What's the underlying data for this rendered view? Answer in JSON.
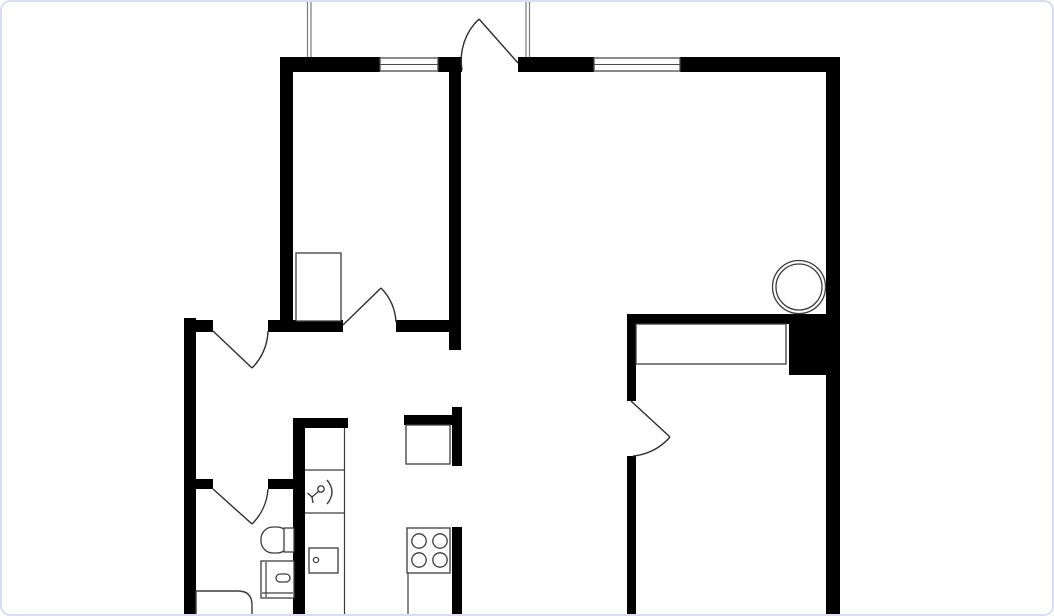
{
  "canvas": {
    "width": 1054,
    "height": 616,
    "background": "#ffffff",
    "card_border_color": "#d8ddf1",
    "card_radius": 10,
    "wall_color": "#000000",
    "line_color": "#3d3d3d",
    "door_color": "#2e2e2e",
    "guide_color": "#7a7a7a"
  },
  "floorplan": {
    "elements": [
      {
        "name": "top-wall-segment-1",
        "kind": "wall",
        "x": 280,
        "y": 57,
        "w": 100,
        "h": 15
      },
      {
        "name": "top-wall-segment-2",
        "kind": "wall",
        "x": 438,
        "y": 57,
        "w": 24,
        "h": 15
      },
      {
        "name": "top-wall-segment-3",
        "kind": "wall",
        "x": 518,
        "y": 57,
        "w": 76,
        "h": 15
      },
      {
        "name": "top-wall-segment-4",
        "kind": "wall",
        "x": 680,
        "y": 57,
        "w": 146,
        "h": 15
      },
      {
        "name": "right-exterior-wall",
        "kind": "wall",
        "x": 826,
        "y": 57,
        "w": 14,
        "h": 559
      },
      {
        "name": "bedroom1-west-wall",
        "kind": "wall",
        "x": 280,
        "y": 57,
        "w": 13,
        "h": 264
      },
      {
        "name": "bedroom1-east-wall",
        "kind": "wall",
        "x": 449,
        "y": 72,
        "w": 12,
        "h": 278
      },
      {
        "name": "hall-north-wall-segment-1",
        "kind": "wall",
        "x": 184,
        "y": 320,
        "w": 29,
        "h": 12
      },
      {
        "name": "hall-north-wall-segment-2",
        "kind": "wall",
        "x": 268,
        "y": 320,
        "w": 75,
        "h": 12
      },
      {
        "name": "hall-north-wall-segment-3",
        "kind": "wall",
        "x": 396,
        "y": 320,
        "w": 65,
        "h": 12
      },
      {
        "name": "left-exterior-wall",
        "kind": "wall",
        "x": 184,
        "y": 318,
        "w": 12,
        "h": 298
      },
      {
        "name": "bathroom-north-wall-segment-1",
        "kind": "wall",
        "x": 196,
        "y": 479,
        "w": 17,
        "h": 10
      },
      {
        "name": "bathroom-north-wall-segment-2",
        "kind": "wall",
        "x": 268,
        "y": 479,
        "w": 37,
        "h": 10
      },
      {
        "name": "kitchen-west-wall",
        "kind": "wall",
        "x": 293,
        "y": 418,
        "w": 12,
        "h": 198
      },
      {
        "name": "kitchen-west-wall-cap",
        "kind": "wall",
        "x": 293,
        "y": 418,
        "w": 55,
        "h": 10
      },
      {
        "name": "shaft-north-wall",
        "kind": "wall",
        "x": 404,
        "y": 415,
        "w": 48,
        "h": 10
      },
      {
        "name": "shaft-east-wall",
        "kind": "wall",
        "x": 452,
        "y": 407,
        "w": 10,
        "h": 59
      },
      {
        "name": "kitchen-east-wall",
        "kind": "wall",
        "x": 452,
        "y": 527,
        "w": 10,
        "h": 89
      },
      {
        "name": "bedroom2-north-wall",
        "kind": "wall",
        "x": 627,
        "y": 314,
        "w": 162,
        "h": 10
      },
      {
        "name": "duct-block",
        "kind": "wall",
        "x": 789,
        "y": 314,
        "w": 37,
        "h": 61
      },
      {
        "name": "bedroom2-west-wall-upper",
        "kind": "wall",
        "x": 627,
        "y": 314,
        "w": 9,
        "h": 87
      },
      {
        "name": "bedroom2-west-wall-lower",
        "kind": "wall",
        "x": 627,
        "y": 456,
        "w": 9,
        "h": 160
      },
      {
        "name": "window-1",
        "kind": "window",
        "x": 380,
        "y": 58,
        "w": 58,
        "h": 13
      },
      {
        "name": "window-2",
        "kind": "window",
        "x": 594,
        "y": 58,
        "w": 86,
        "h": 13
      },
      {
        "name": "exterior-guide-line-1",
        "kind": "line",
        "x1": 307.5,
        "y1": 0,
        "x2": 307.5,
        "y2": 57,
        "stroke": "#7a7a7a"
      },
      {
        "name": "exterior-guide-line-2",
        "kind": "line",
        "x1": 311,
        "y1": 0,
        "x2": 311,
        "y2": 57,
        "stroke": "#7a7a7a"
      },
      {
        "name": "exterior-guide-line-3",
        "kind": "line",
        "x1": 526,
        "y1": 0,
        "x2": 526,
        "y2": 57,
        "stroke": "#7a7a7a"
      },
      {
        "name": "exterior-guide-line-4",
        "kind": "line",
        "x1": 529.5,
        "y1": 0,
        "x2": 529.5,
        "y2": 57,
        "stroke": "#7a7a7a"
      },
      {
        "name": "bedroom1-closet",
        "kind": "rect",
        "x": 296,
        "y": 253,
        "w": 45,
        "h": 68
      },
      {
        "name": "bedroom2-closet",
        "kind": "rect",
        "x": 636,
        "y": 324,
        "w": 150,
        "h": 40
      },
      {
        "name": "shaft-box",
        "kind": "rect",
        "x": 406,
        "y": 425,
        "w": 44,
        "h": 39
      },
      {
        "name": "counter-left-front-edge",
        "kind": "line",
        "x1": 344.5,
        "y1": 428,
        "x2": 344.5,
        "y2": 614
      },
      {
        "name": "counter-left-divider-1",
        "kind": "line",
        "x1": 305,
        "y1": 470,
        "x2": 344,
        "y2": 470
      },
      {
        "name": "counter-left-divider-2",
        "kind": "line",
        "x1": 305,
        "y1": 513,
        "x2": 344,
        "y2": 513
      },
      {
        "name": "counter-right-front-edge",
        "kind": "line",
        "x1": 408,
        "y1": 573,
        "x2": 408,
        "y2": 614
      },
      {
        "name": "kitchen-appliance",
        "kind": "rect",
        "x": 309,
        "y": 548,
        "w": 29,
        "h": 25
      },
      {
        "name": "kitchen-appliance-knob",
        "kind": "circle",
        "cx": 316,
        "cy": 560,
        "r": 2.6
      },
      {
        "name": "stove",
        "kind": "rect",
        "x": 407,
        "y": 528,
        "w": 43,
        "h": 45
      },
      {
        "name": "stove-burner-1",
        "kind": "circle",
        "cx": 419,
        "cy": 541,
        "r": 7.2
      },
      {
        "name": "stove-burner-2",
        "kind": "circle",
        "cx": 440,
        "cy": 541,
        "r": 7.2
      },
      {
        "name": "stove-burner-3",
        "kind": "circle",
        "cx": 419,
        "cy": 560,
        "r": 7.2
      },
      {
        "name": "stove-burner-4",
        "kind": "circle",
        "cx": 440,
        "cy": 560,
        "r": 7.2
      },
      {
        "name": "kitchen-sink-faucet-ring",
        "kind": "circle",
        "cx": 321,
        "cy": 489,
        "r": 3.2
      },
      {
        "name": "kitchen-sink-faucet-curve",
        "kind": "path",
        "d": "M327,480 Q337,492 327,504"
      },
      {
        "name": "kitchen-sink-faucet-tap",
        "kind": "path",
        "d": "M312,497 L319,491 M312,497 L307.5,493 M312,497 L313,503"
      },
      {
        "name": "toilet-bowl",
        "kind": "rrect",
        "x": 261,
        "y": 527,
        "w": 28,
        "h": 26,
        "rx": 12
      },
      {
        "name": "toilet-tank",
        "kind": "rect",
        "x": 284,
        "y": 528,
        "w": 10,
        "h": 24
      },
      {
        "name": "bathroom-sink",
        "kind": "rect",
        "x": 261,
        "y": 561,
        "w": 33,
        "h": 37
      },
      {
        "name": "bathroom-sink-inner-left",
        "kind": "line",
        "x1": 266,
        "y1": 562,
        "x2": 266,
        "y2": 597
      },
      {
        "name": "bathroom-sink-inner-bottom",
        "kind": "line",
        "x1": 262,
        "y1": 593,
        "x2": 293,
        "y2": 593
      },
      {
        "name": "bathroom-sink-faucet",
        "kind": "rrect",
        "x": 276,
        "y": 574,
        "w": 14,
        "h": 8,
        "rx": 4
      },
      {
        "name": "bathtub",
        "kind": "path",
        "d": "M196,591 L238,591 Q252,591 252,605 L252,616 L196,616 Z",
        "fill": "#ffffff"
      },
      {
        "name": "round-column-outer",
        "kind": "circle",
        "cx": 799,
        "cy": 287,
        "r": 26.5
      },
      {
        "name": "round-column-inner",
        "kind": "circle",
        "cx": 799,
        "cy": 287,
        "r": 23
      },
      {
        "name": "entry-door-leaf",
        "kind": "path",
        "d": "M518,63 L479,19",
        "stroke": "#2e2e2e"
      },
      {
        "name": "entry-door-swing",
        "kind": "path",
        "d": "M479,19 A57,57 0 0 0 462,70",
        "stroke": "#2e2e2e"
      },
      {
        "name": "hall-door-leaf",
        "kind": "path",
        "d": "M213,331 L252,368",
        "stroke": "#2e2e2e"
      },
      {
        "name": "hall-door-swing",
        "kind": "path",
        "d": "M252,368 A54,54 0 0 0 268,331",
        "stroke": "#2e2e2e"
      },
      {
        "name": "bedroom1-door-leaf",
        "kind": "path",
        "d": "M343,325 L381,288",
        "stroke": "#2e2e2e"
      },
      {
        "name": "bedroom1-door-swing",
        "kind": "path",
        "d": "M381,288 A53,53 0 0 1 396,322",
        "stroke": "#2e2e2e"
      },
      {
        "name": "bathroom-door-leaf",
        "kind": "path",
        "d": "M213,489 L252,524",
        "stroke": "#2e2e2e"
      },
      {
        "name": "bathroom-door-swing",
        "kind": "path",
        "d": "M252,524 A54,54 0 0 0 268,489",
        "stroke": "#2e2e2e"
      },
      {
        "name": "bedroom2-door-leaf",
        "kind": "path",
        "d": "M631,401 L670,437",
        "stroke": "#2e2e2e"
      },
      {
        "name": "bedroom2-door-swing",
        "kind": "path",
        "d": "M670,437 A55,55 0 0 1 633,456",
        "stroke": "#2e2e2e"
      }
    ]
  }
}
